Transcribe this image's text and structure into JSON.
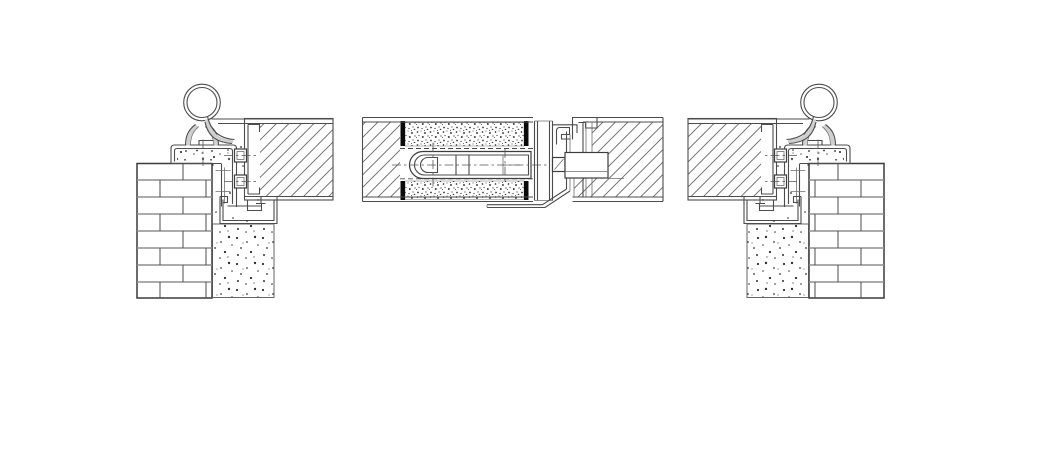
{
  "drawing": {
    "title": "Double-leaf steel door - horizontal section details",
    "details": [
      {
        "id": "left-jamb",
        "label": "hinge jamb detail left"
      },
      {
        "id": "meeting-stiles",
        "label": "meeting stiles and lock detail center"
      },
      {
        "id": "right-jamb",
        "label": "hinge jamb detail right"
      }
    ],
    "components": {
      "wall": "brick masonry wall",
      "infill": "plaster-concrete infill",
      "frame": "steel frame profile",
      "hinge": "weld-on barrel hinge",
      "leaf": "door leaf section",
      "insulation": "mineral insulation infill",
      "lock": "mortise lock case",
      "latch": "latch bolt",
      "astragal": "astragal overlap profile",
      "strike": "strike box recess",
      "anchor": "frame anchor bolt",
      "channel": "floor channel profile"
    }
  },
  "colors": {
    "paper": "#ffffff",
    "line": "#4c4c4c",
    "line_dark": "#383838",
    "line_light": "#cfcfcf",
    "mortar": "#8f8f8f",
    "cap": "#0a0a0a",
    "hatch": "#6b6b6b",
    "speckle": "#2f2f2f"
  }
}
